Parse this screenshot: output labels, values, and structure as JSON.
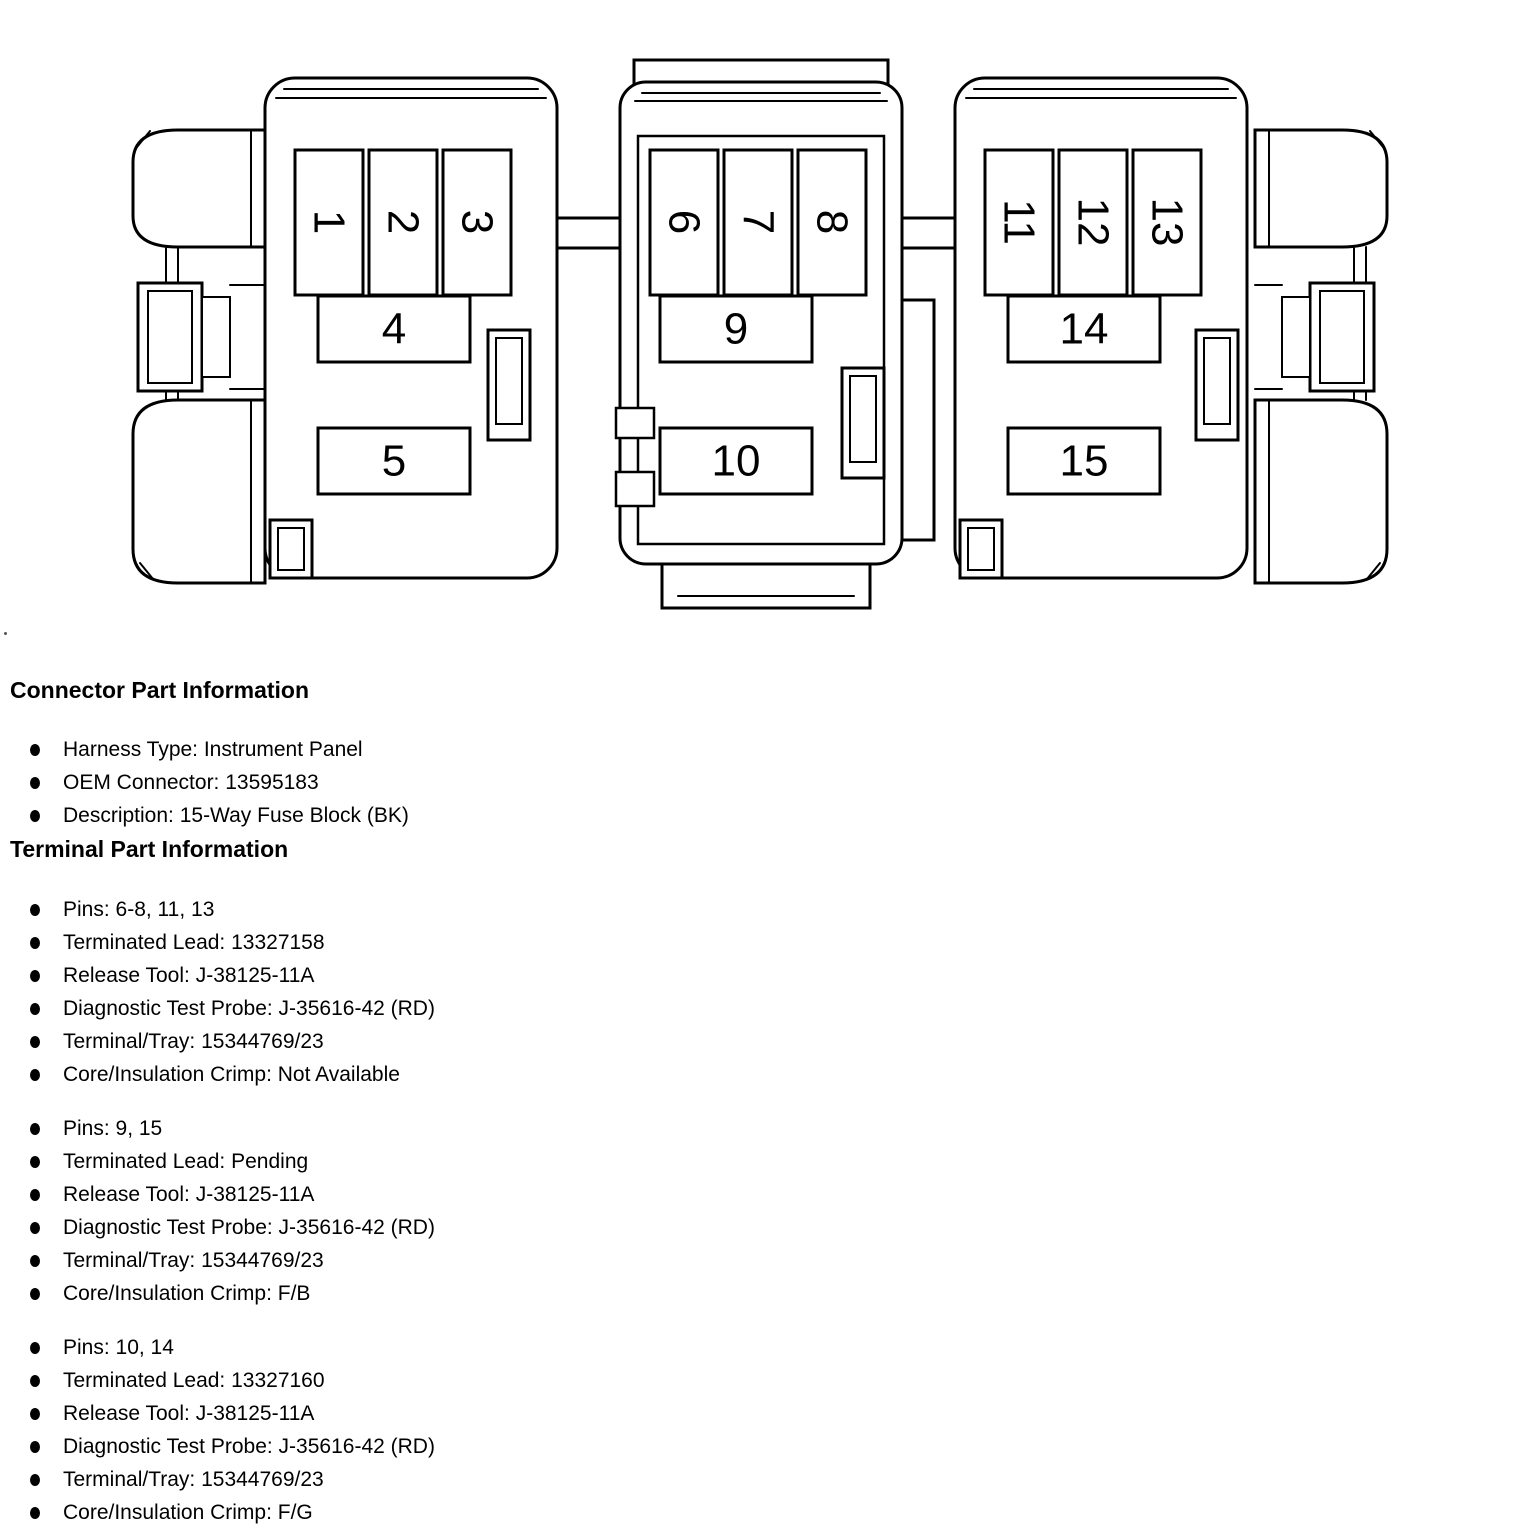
{
  "colors": {
    "ink": "#000000",
    "background": "#ffffff"
  },
  "diagram": {
    "description": "15-Way Fuse Block connector face view, three pods with latch wings",
    "pins": [
      "1",
      "2",
      "3",
      "4",
      "5",
      "6",
      "7",
      "8",
      "9",
      "10",
      "11",
      "12",
      "13",
      "14",
      "15"
    ]
  },
  "connector_info": {
    "title": "Connector Part Information",
    "items": [
      "Harness Type: Instrument Panel",
      "OEM Connector: 13595183",
      "Description: 15-Way Fuse Block (BK)"
    ]
  },
  "terminal_info": {
    "title": "Terminal Part Information",
    "groups": [
      {
        "items": [
          "Pins: 6-8, 11, 13",
          "Terminated Lead: 13327158",
          "Release Tool: J-38125-11A",
          "Diagnostic Test Probe: J-35616-42 (RD)",
          "Terminal/Tray: 15344769/23",
          "Core/Insulation Crimp: Not Available"
        ]
      },
      {
        "items": [
          "Pins: 9, 15",
          "Terminated Lead: Pending",
          "Release Tool: J-38125-11A",
          "Diagnostic Test Probe: J-35616-42 (RD)",
          "Terminal/Tray: 15344769/23",
          "Core/Insulation Crimp: F/B"
        ]
      },
      {
        "items": [
          "Pins: 10, 14",
          "Terminated Lead: 13327160",
          "Release Tool: J-38125-11A",
          "Diagnostic Test Probe: J-35616-42 (RD)",
          "Terminal/Tray: 15344769/23",
          "Core/Insulation Crimp: F/G"
        ]
      }
    ]
  }
}
